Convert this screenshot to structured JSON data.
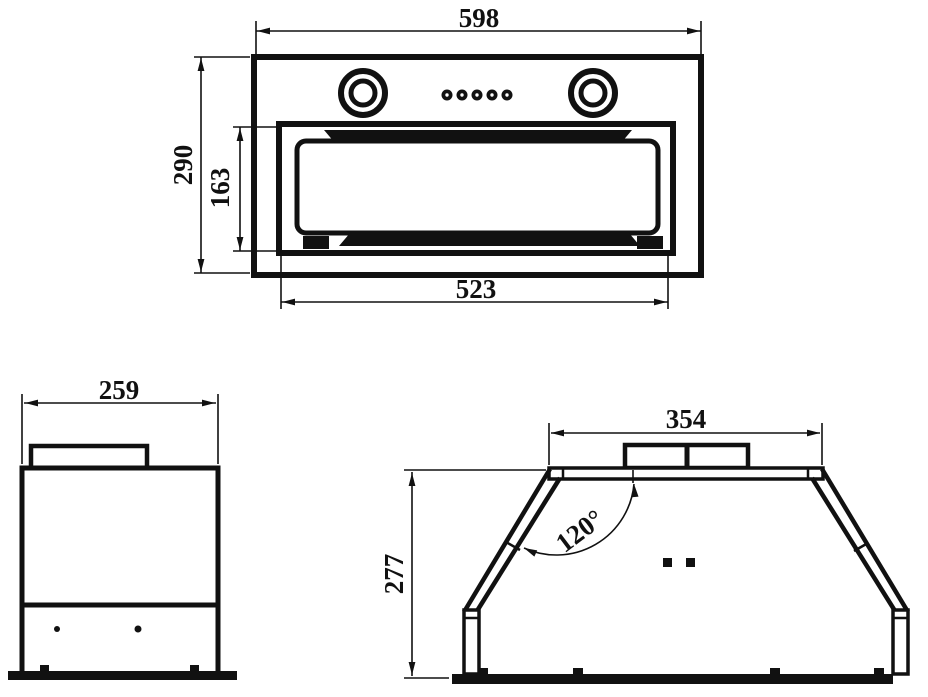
{
  "colors": {
    "line": "#111111",
    "background": "#ffffff"
  },
  "views": {
    "front": {
      "overall_width": "598",
      "overall_height": "290",
      "filter_height": "163",
      "filter_width": "523"
    },
    "side": {
      "depth": "259"
    },
    "profile": {
      "duct_top_width": "354",
      "height": "277",
      "angle": "120°"
    }
  }
}
